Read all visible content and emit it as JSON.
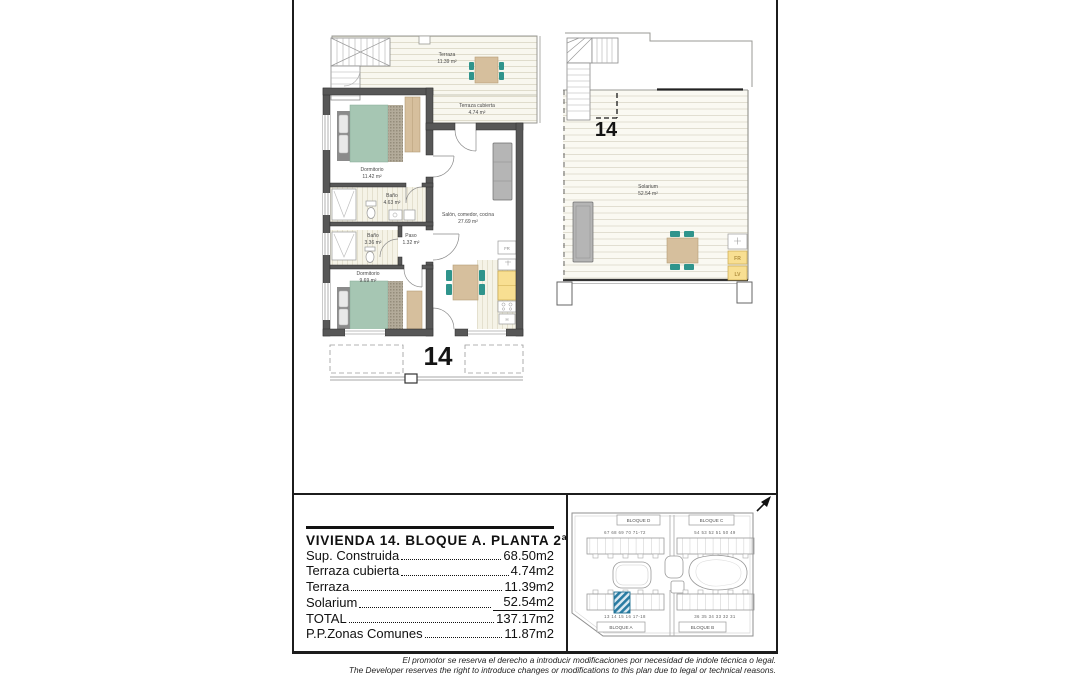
{
  "page": {
    "unit_number": "14"
  },
  "main_plan": {
    "unit_label": "14",
    "rooms": {
      "terraza": {
        "name": "Terraza",
        "area": "11.39 m²"
      },
      "terraza_cubierta": {
        "name": "Terraza cubierta",
        "area": "4.74 m²"
      },
      "dormitorio1": {
        "name": "Dormitorio",
        "area": "11.42 m²"
      },
      "bano1": {
        "name": "Baño",
        "area": "4.63 m²"
      },
      "bano2": {
        "name": "Baño",
        "area": "3.36 m²"
      },
      "paso": {
        "name": "Paso",
        "area": "1.32 m²"
      },
      "dormitorio2": {
        "name": "Dormitorio",
        "area": "9.69 m²"
      },
      "salon": {
        "name": "Salón, comedor, cocina",
        "area": "27.69 m²"
      }
    },
    "appliances": {
      "fridge": "FR",
      "oven": "H"
    }
  },
  "solarium_plan": {
    "unit_label": "14",
    "room": {
      "name": "Solarium",
      "area": "52.54 m²"
    },
    "appliances": {
      "fridge": "FR",
      "dishwasher": "LV"
    }
  },
  "info_panel": {
    "title": "VIVIENDA 14. BLOQUE A. PLANTA 2ª",
    "rows": [
      {
        "label": "Sup. Construida",
        "value": "68.50m2"
      },
      {
        "label": "Terraza cubierta",
        "value": "4.74m2"
      },
      {
        "label": "Terraza",
        "value": "11.39m2"
      },
      {
        "label": "Solarium",
        "value": "52.54m2"
      },
      {
        "label": "TOTAL",
        "value": "137.17m2"
      },
      {
        "label": "P.P.Zonas Comunes",
        "value": "11.87m2"
      }
    ]
  },
  "site_plan": {
    "blocks": {
      "top_left": "BLOQUE D",
      "top_right": "BLOQUE C",
      "bottom_left": "BLOQUE A",
      "bottom_right": "BLOQUE B"
    },
    "numbers": {
      "top_left": "67  68  69  70  71-72",
      "top_right": "54 53  52  51  50  49",
      "bottom_left": "13  14  15  16  17-18",
      "bottom_right": "36 35  34  33  32  31"
    },
    "highlighted_unit": "14"
  },
  "disclaimer": {
    "line_es": "El promotor se reserva el derecho a introducir modificaciones por necesidad de indole técnica o legal.",
    "line_en": "The Developer reserves the right to introduce changes or modifications to this plan due to legal or technical reasons."
  },
  "colors": {
    "wall": "#575757",
    "bed_green": "#a6c6b3",
    "wood_tan": "#d6bf9d",
    "chair_teal": "#2f948c",
    "counter_yellow": "#f8df92",
    "sofa_gray": "#b5b5b5",
    "marker_blue": "#2a7ca3"
  }
}
